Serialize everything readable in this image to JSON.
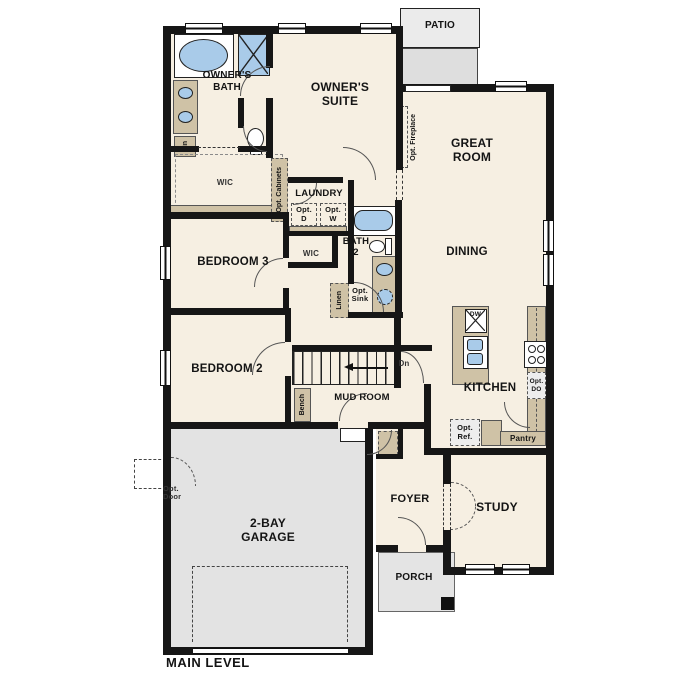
{
  "title": "MAIN LEVEL",
  "colors": {
    "wall": "#161616",
    "floor_cream": "#f6efe2",
    "fixture_blue": "#a9cbe9",
    "cabinet_tan": "#cfc2a6",
    "concrete_gray": "#e3e3e3"
  },
  "rooms": {
    "patio": "PATIO",
    "owners_bath": "OWNER'S\nBATH",
    "owners_suite": "OWNER'S\nSUITE",
    "great_room": "GREAT\nROOM",
    "wic_owners": "WIC",
    "laundry": "LAUNDRY",
    "bath2": "BATH\n2",
    "dining": "DINING",
    "bedroom3": "BEDROOM 3",
    "wic2": "WIC",
    "bedroom2": "BEDROOM 2",
    "mud_room": "MUD ROOM",
    "kitchen": "KITCHEN",
    "garage": "2-BAY\nGARAGE",
    "foyer": "FOYER",
    "study": "STUDY",
    "porch": "PORCH"
  },
  "annotations": {
    "lin": "Lin",
    "opt_cabinets": "Opt. Cabinets",
    "opt_fireplace": "Opt. Fireplace",
    "opt_d": "Opt.\nD",
    "opt_w": "Opt.\nW",
    "linen": "Linen",
    "opt_sink": "Opt.\nSink",
    "bench": "Bench",
    "dn": "Dn",
    "dw": "DW",
    "opt_do": "Opt.\nDO",
    "opt_ref": "Opt.\nRef.",
    "pantry": "Pantry",
    "opt_door": "Opt.\nDoor"
  }
}
